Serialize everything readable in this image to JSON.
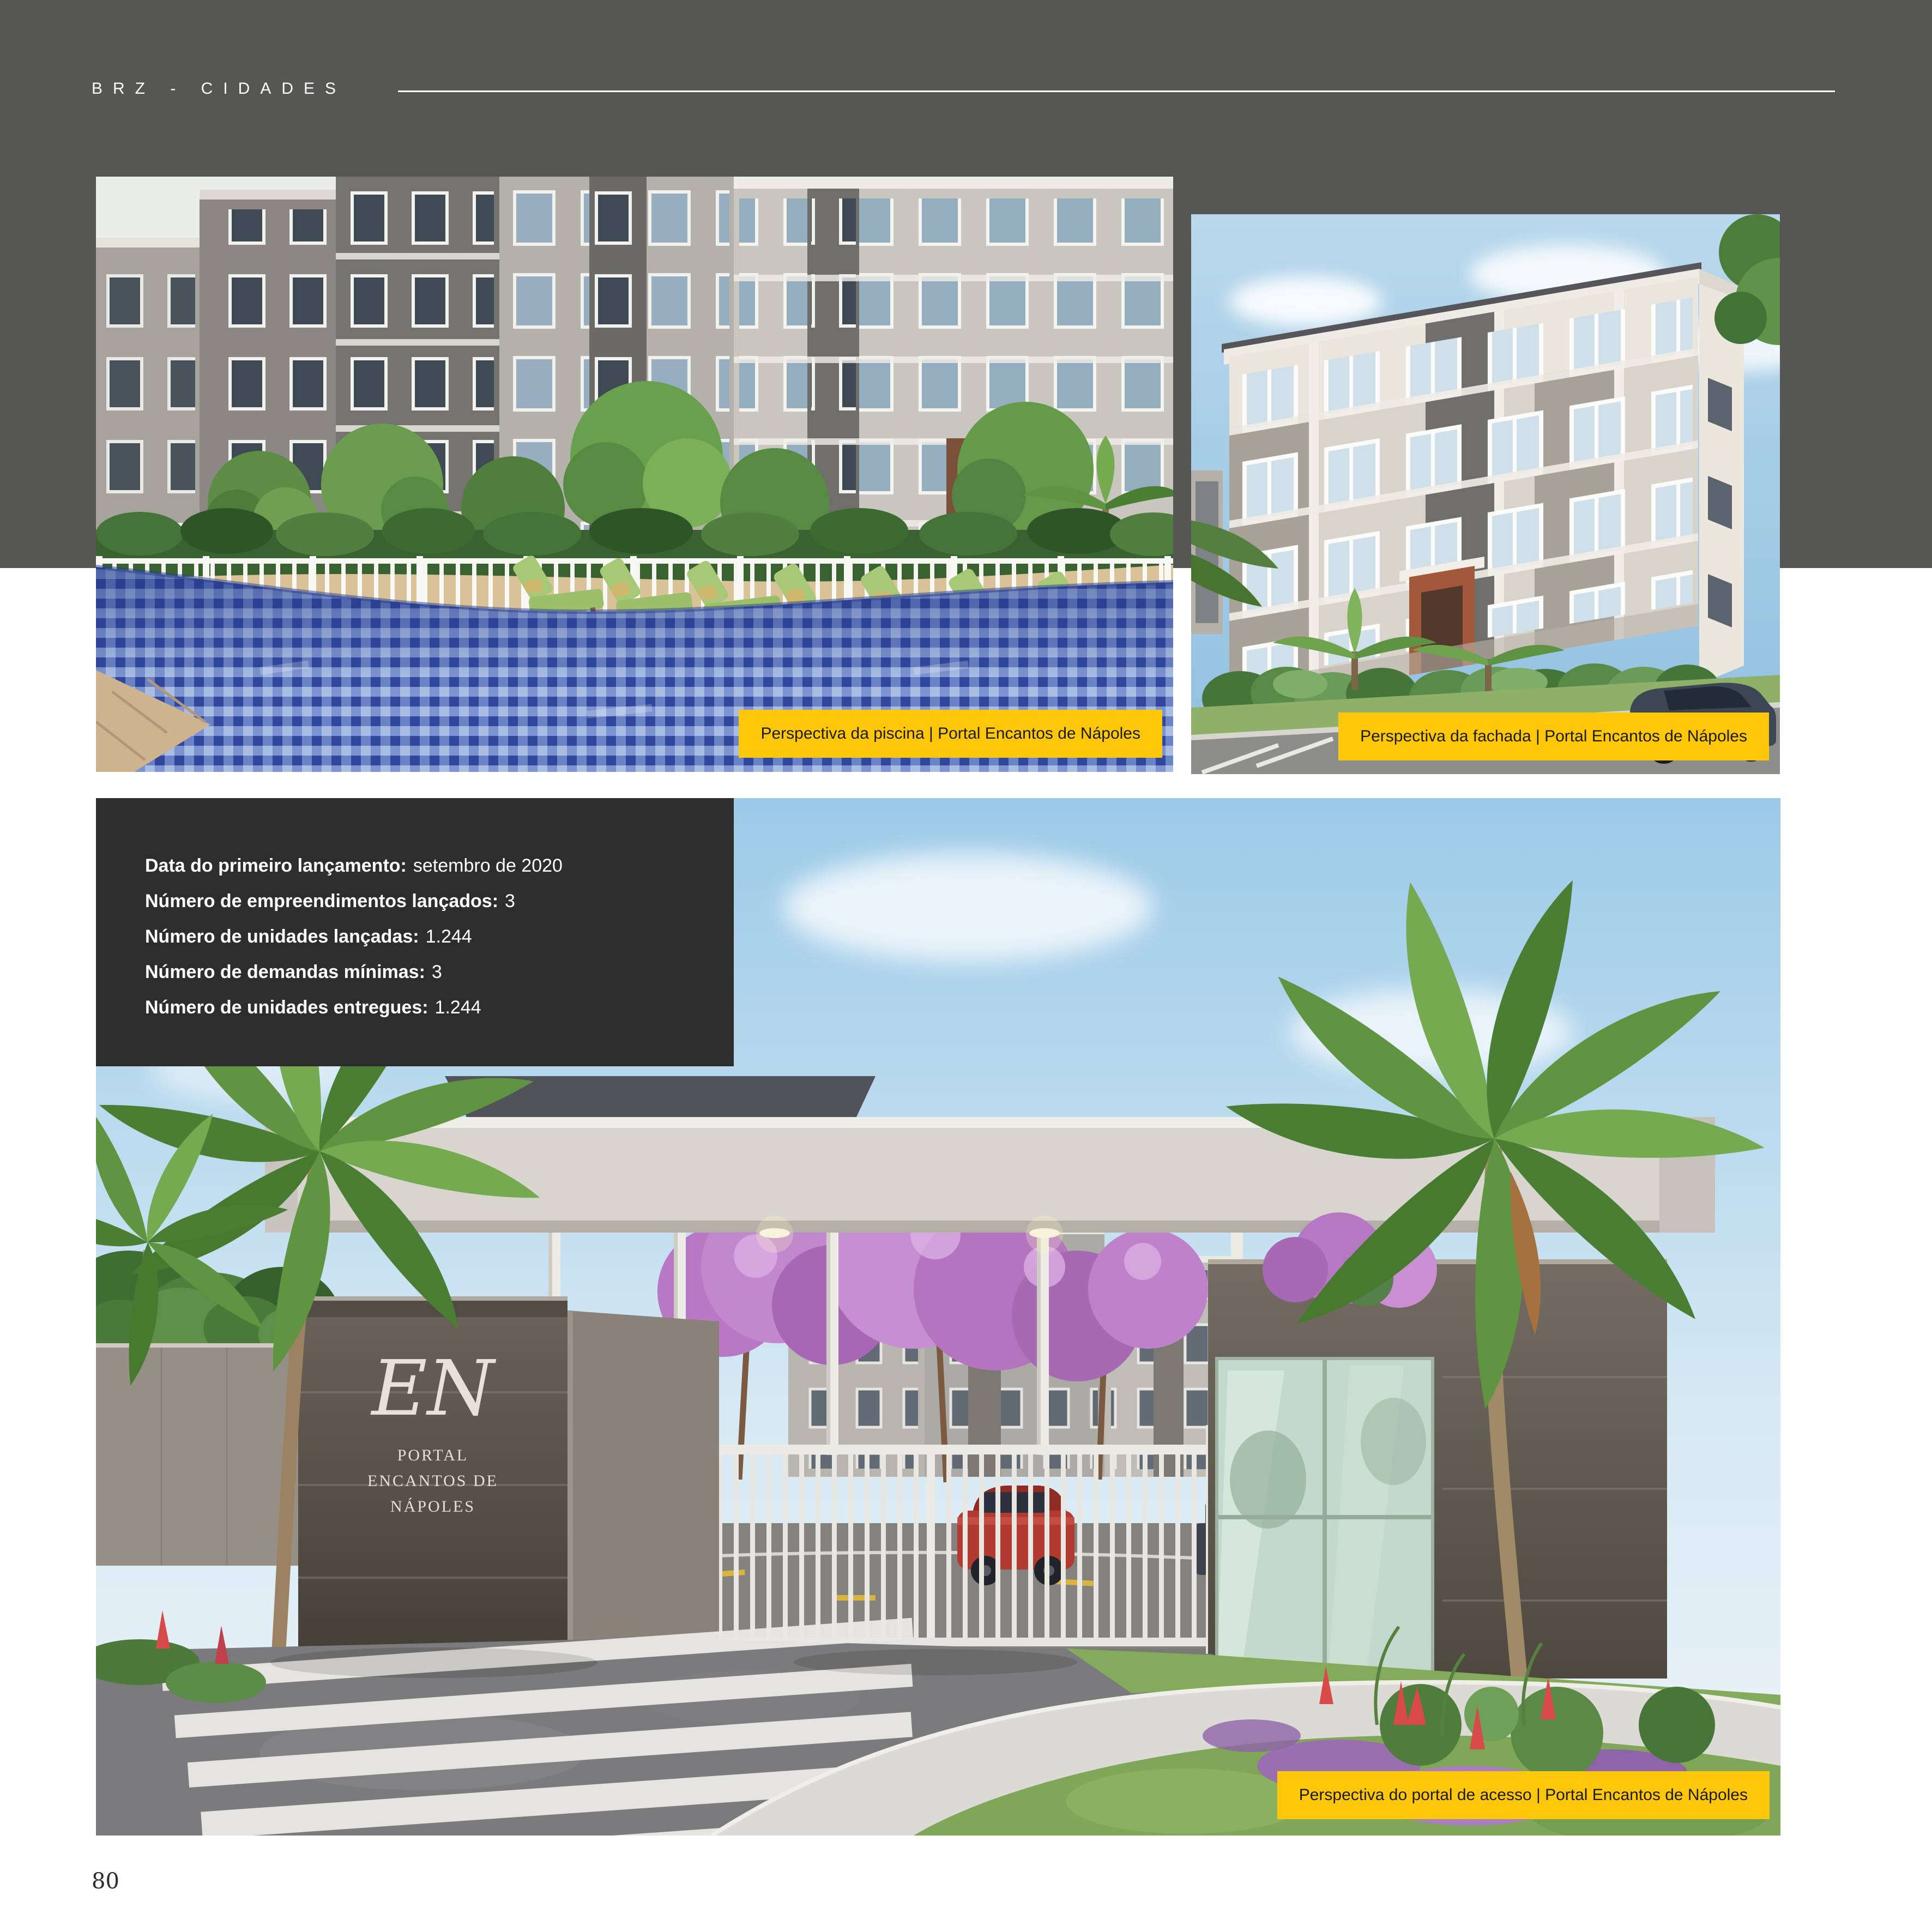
{
  "header": {
    "kicker": "BRZ - CIDADES"
  },
  "figures": {
    "pool": {
      "caption": "Perspectiva da piscina | Portal Encantos de Nápoles"
    },
    "facade": {
      "caption": "Perspectiva da fachada | Portal Encantos de Nápoles"
    },
    "portal": {
      "caption": "Perspectiva do portal de acesso | Portal Encantos de Nápoles"
    }
  },
  "info_panel": {
    "rows": [
      {
        "label": "Data do primeiro lançamento:",
        "value": "setembro de 2020"
      },
      {
        "label": "Número de empreendimentos lançados:",
        "value": "3"
      },
      {
        "label": "Número de unidades lançadas:",
        "value": "1.244"
      },
      {
        "label": "Número de demandas mínimas:",
        "value": "3"
      },
      {
        "label": "Número de unidades entregues:",
        "value": "1.244"
      }
    ]
  },
  "portal_sign": {
    "monogram": "EN",
    "lines": [
      "PORTAL",
      "ENCANTOS DE",
      "NÁPOLES"
    ]
  },
  "footer": {
    "page_number": "80"
  },
  "colors": {
    "accent_yellow": "#FFC70A",
    "header_band_gray": "#565655",
    "info_panel_dark": "#2D2D2D"
  }
}
